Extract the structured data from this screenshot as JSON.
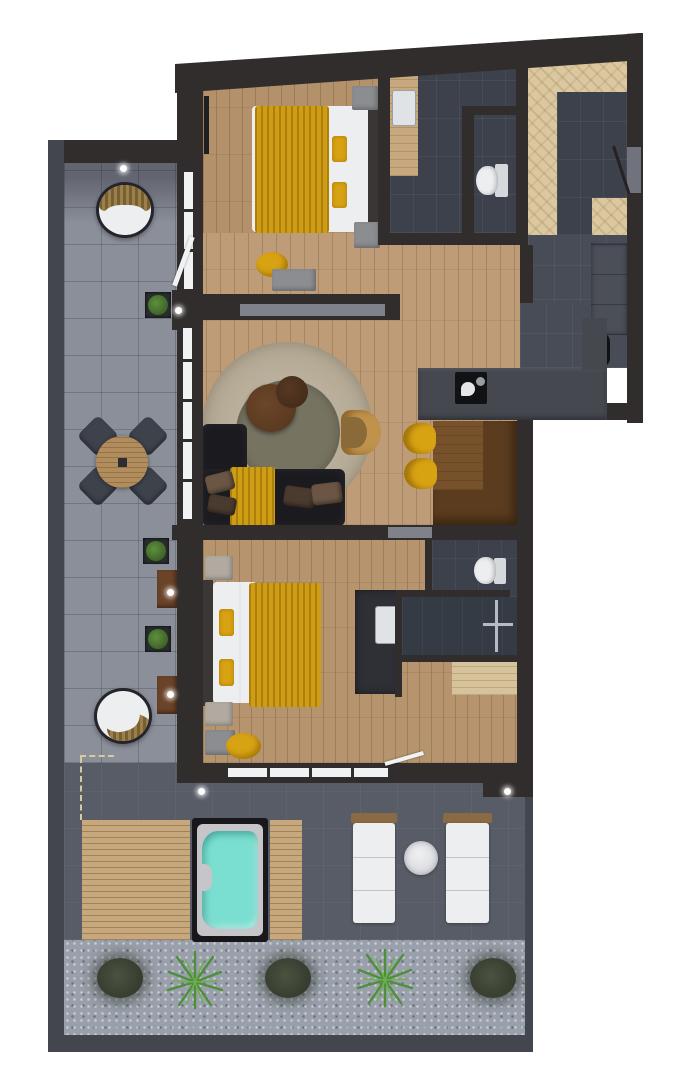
{
  "scene": {
    "label": "3d-rendered-apartment-floor-plan-top-view",
    "background": "#ffffff"
  },
  "palette": {
    "wall": "#322d2d",
    "border_dark": "#43464f",
    "floor_wood": "#b3916b",
    "floor_wood_living": "#bd9c77",
    "floor_wood_b2": "#b5946e",
    "entry_wood": "#dcc8a0",
    "bench_wood": "#d6c39c",
    "slate": "#3c414b",
    "slate_dark": "#353b45",
    "hall_slate": "#474c56",
    "terrace": "#8b8f9a",
    "terrace_dark": "#585c66",
    "walkway": "#99a0ab",
    "deck": "#c7a87c",
    "deck_edge": "#d9c9a0",
    "water": "#7adfd1",
    "tub_rim": "#c6c6ca",
    "tub_frame": "#18181c",
    "yellow": "#d8a313",
    "blanket": "#cf9d13",
    "white_furn": "#eceeef",
    "sofa": "#1a1a1f",
    "rug": "#b2a792",
    "rug_inner": "#767361",
    "table_brown": "#5c3c1e",
    "table_brown_light": "#76512a",
    "wood_table": "#b18c5c",
    "chair_dark": "#3e424b",
    "armchair": "#c0934d",
    "armchair_seat": "#8a6a38",
    "counter": "#45484f",
    "cooktop": "#111214",
    "closet": "#4b4f58",
    "gray_furn": "#8b8d90",
    "pocket_door": "#7f828a",
    "window": "#f0f2f4",
    "planter": "#2b2e33",
    "side_table": "#6b4328",
    "vanity_wood": "#c8a97f",
    "vanity_dark": "#2e3036",
    "sink": "#dfe3e6",
    "toilet": "#eceef0",
    "coffee_table": "#53351f",
    "coffee_table2": "#3f2817",
    "pillow_brown": "#6b5644",
    "pillow_brown2": "#4a3b2e"
  },
  "regions": {
    "terrace": "tiled terrace",
    "bedroom_top": "bedroom 1 with double bed",
    "bathroom_top": "bathroom with toilet and vanity",
    "entry": "entrance hall",
    "hall": "hallway with wardrobe",
    "kitchen": "kitchen with counter and cooktop",
    "dining": "dining table with yellow chairs",
    "living": "living room with sofa and round rug",
    "bedroom_bottom": "bedroom 2 with double bed",
    "bathroom_bottom": "shower room with toilet",
    "deck": "wooden pool deck",
    "hot_tub": "hot tub with turquoise water",
    "loungers": "two white sun loungers",
    "walkway": "gravel walkway with plants"
  }
}
